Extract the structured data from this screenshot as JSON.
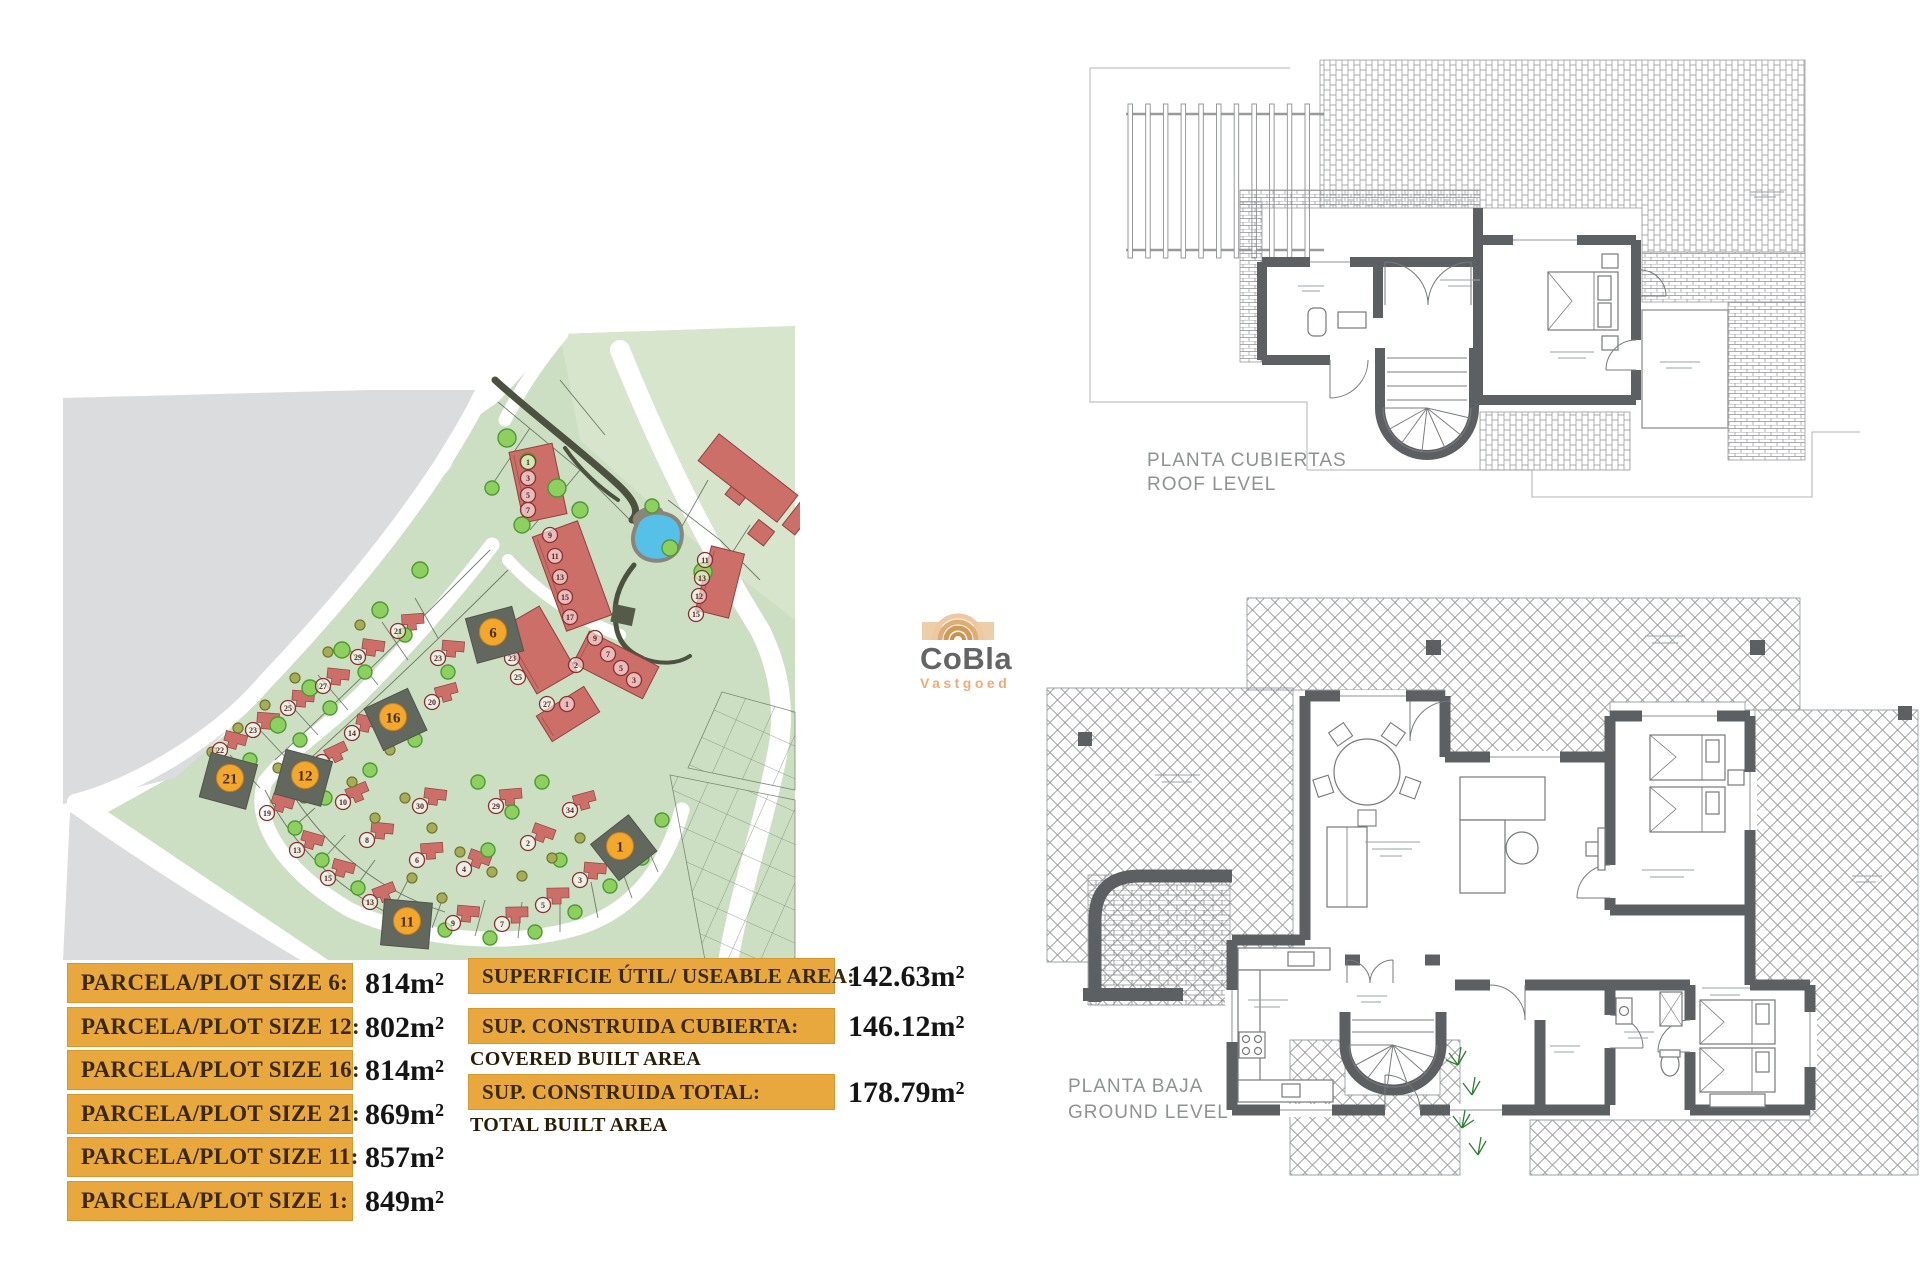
{
  "branding": {
    "logo_text": "CoBla",
    "logo_subtext": "Vastgoed"
  },
  "plot_sizes": [
    {
      "label": "PARCELA/PLOT SIZE 6:",
      "value": "814m²"
    },
    {
      "label": "PARCELA/PLOT SIZE 12:",
      "value": "802m²"
    },
    {
      "label": "PARCELA/PLOT SIZE 16:",
      "value": "814m²"
    },
    {
      "label": "PARCELA/PLOT SIZE 21:",
      "value": "869m²"
    },
    {
      "label": "PARCELA/PLOT SIZE 11:",
      "value": "857m²"
    },
    {
      "label": "PARCELA/PLOT SIZE 1:",
      "value": "849m²"
    }
  ],
  "build_areas": [
    {
      "label": "SUPERFICIE ÚTIL/ USEABLE AREA:",
      "value": "142.63m²",
      "sublabel": ""
    },
    {
      "label": "SUP. CONSTRUIDA CUBIERTA:",
      "value": "146.12m²",
      "sublabel": "COVERED BUILT AREA"
    },
    {
      "label": "SUP. CONSTRUIDA TOTAL:",
      "value": "178.79m²",
      "sublabel": "TOTAL BUILT AREA"
    }
  ],
  "floor_plans": {
    "roof": {
      "title_es": "PLANTA CUBIERTAS",
      "title_en": "ROOF LEVEL"
    },
    "ground": {
      "title_es": "PLANTA BAJA",
      "title_en": "GROUND LEVEL"
    }
  },
  "site_plan": {
    "colors": {
      "map_green": "#ccdfc2",
      "map_gray": "#dbdcdd",
      "house_red": "#cb6f68",
      "plot_dark": "#63685f",
      "highlight_orange": "#f4a72d",
      "pond_blue": "#55c1e9",
      "tree_green": "#8ed060",
      "tree_olive": "#a6ad54",
      "accent_bar": "#e9a83e"
    },
    "highlighted_plots": [
      {
        "n": "6",
        "x": 433,
        "y": 309,
        "r": -15
      },
      {
        "n": "16",
        "x": 333,
        "y": 394,
        "r": -25
      },
      {
        "n": "12",
        "x": 245,
        "y": 452,
        "r": 15
      },
      {
        "n": "21",
        "x": 170,
        "y": 455,
        "r": 15
      },
      {
        "n": "11",
        "x": 347,
        "y": 598,
        "r": 5
      },
      {
        "n": "1",
        "x": 560,
        "y": 523,
        "r": -38
      }
    ],
    "unit_markers": [
      {
        "n": "19",
        "x": 207,
        "y": 493,
        "h": 1
      },
      {
        "n": "13",
        "x": 237,
        "y": 530,
        "h": 1
      },
      {
        "n": "15",
        "x": 268,
        "y": 558,
        "h": 1
      },
      {
        "n": "13",
        "x": 310,
        "y": 582,
        "h": 1
      },
      {
        "n": "9",
        "x": 393,
        "y": 603,
        "h": 1
      },
      {
        "n": "7",
        "x": 442,
        "y": 604,
        "h": 1
      },
      {
        "n": "5",
        "x": 483,
        "y": 585,
        "h": 1
      },
      {
        "n": "3",
        "x": 520,
        "y": 560,
        "h": 1
      },
      {
        "n": "2",
        "x": 468,
        "y": 523,
        "h": 1
      },
      {
        "n": "4",
        "x": 404,
        "y": 549,
        "h": 1
      },
      {
        "n": "6",
        "x": 357,
        "y": 540,
        "h": 1
      },
      {
        "n": "8",
        "x": 307,
        "y": 520,
        "h": 1
      },
      {
        "n": "10",
        "x": 283,
        "y": 482,
        "h": 1
      },
      {
        "n": "30",
        "x": 360,
        "y": 486,
        "h": 1
      },
      {
        "n": "29",
        "x": 436,
        "y": 486,
        "h": 1
      },
      {
        "n": "34",
        "x": 510,
        "y": 490,
        "h": 1
      },
      {
        "n": "21",
        "x": 338,
        "y": 311,
        "h": 1
      },
      {
        "n": "29",
        "x": 298,
        "y": 337,
        "h": 1
      },
      {
        "n": "27",
        "x": 263,
        "y": 366,
        "h": 1
      },
      {
        "n": "25",
        "x": 228,
        "y": 388,
        "h": 1
      },
      {
        "n": "23",
        "x": 193,
        "y": 410,
        "h": 1
      },
      {
        "n": "22",
        "x": 160,
        "y": 430,
        "h": 1
      },
      {
        "n": "23",
        "x": 378,
        "y": 338,
        "h": 1
      },
      {
        "n": "20",
        "x": 372,
        "y": 382,
        "h": 1
      },
      {
        "n": "14",
        "x": 292,
        "y": 413,
        "h": 1
      },
      {
        "n": "18",
        "x": 262,
        "y": 442,
        "h": 1
      },
      {
        "n": "1",
        "x": 468,
        "y": 142,
        "h": 0
      },
      {
        "n": "3",
        "x": 468,
        "y": 158,
        "h": 0
      },
      {
        "n": "5",
        "x": 468,
        "y": 175,
        "h": 0
      },
      {
        "n": "7",
        "x": 468,
        "y": 190,
        "h": 0
      },
      {
        "n": "9",
        "x": 490,
        "y": 215,
        "h": 0
      },
      {
        "n": "11",
        "x": 495,
        "y": 236,
        "h": 0
      },
      {
        "n": "13",
        "x": 500,
        "y": 257,
        "h": 0
      },
      {
        "n": "15",
        "x": 505,
        "y": 277,
        "h": 0
      },
      {
        "n": "17",
        "x": 510,
        "y": 297,
        "h": 0
      },
      {
        "n": "19",
        "x": 440,
        "y": 298,
        "h": 0
      },
      {
        "n": "21",
        "x": 446,
        "y": 318,
        "h": 0
      },
      {
        "n": "23",
        "x": 452,
        "y": 338,
        "h": 0
      },
      {
        "n": "25",
        "x": 458,
        "y": 357,
        "h": 0
      },
      {
        "n": "27",
        "x": 487,
        "y": 384,
        "h": 0
      },
      {
        "n": "1",
        "x": 507,
        "y": 384,
        "h": 0
      },
      {
        "n": "11",
        "x": 645,
        "y": 240,
        "h": 0
      },
      {
        "n": "13",
        "x": 642,
        "y": 258,
        "h": 0
      },
      {
        "n": "12",
        "x": 639,
        "y": 276,
        "h": 0
      },
      {
        "n": "15",
        "x": 636,
        "y": 294,
        "h": 0
      },
      {
        "n": "9",
        "x": 535,
        "y": 318,
        "h": 0
      },
      {
        "n": "7",
        "x": 548,
        "y": 334,
        "h": 0
      },
      {
        "n": "5",
        "x": 561,
        "y": 348,
        "h": 0
      },
      {
        "n": "3",
        "x": 574,
        "y": 360,
        "h": 0
      },
      {
        "n": "2",
        "x": 516,
        "y": 345,
        "h": 0
      }
    ],
    "townhouse_rows": [
      {
        "x": 478,
        "y": 163,
        "w": 44,
        "h": 72,
        "r": -12
      },
      {
        "x": 512,
        "y": 256,
        "w": 48,
        "h": 100,
        "r": -20
      },
      {
        "x": 478,
        "y": 330,
        "w": 46,
        "h": 75,
        "r": -30
      },
      {
        "x": 508,
        "y": 394,
        "w": 56,
        "h": 30,
        "r": -32
      },
      {
        "x": 660,
        "y": 262,
        "w": 34,
        "h": 66,
        "r": 14
      },
      {
        "x": 556,
        "y": 345,
        "w": 78,
        "h": 36,
        "r": 27
      }
    ],
    "trees_green": [
      [
        447,
        118,
        9
      ],
      [
        468,
        141,
        8
      ],
      [
        497,
        168,
        9
      ],
      [
        520,
        190,
        8
      ],
      [
        432,
        168,
        7
      ],
      [
        462,
        205,
        8
      ],
      [
        610,
        228,
        8
      ],
      [
        643,
        252,
        9
      ],
      [
        592,
        186,
        7
      ],
      [
        360,
        250,
        8
      ],
      [
        320,
        290,
        8
      ],
      [
        282,
        330,
        8
      ],
      [
        250,
        368,
        8
      ],
      [
        218,
        405,
        8
      ],
      [
        190,
        440,
        7
      ],
      [
        240,
        420,
        7
      ],
      [
        270,
        388,
        7
      ],
      [
        305,
        352,
        7
      ],
      [
        345,
        315,
        7
      ],
      [
        388,
        352,
        7
      ],
      [
        355,
        420,
        7
      ],
      [
        310,
        450,
        7
      ],
      [
        265,
        478,
        7
      ],
      [
        235,
        508,
        7
      ],
      [
        262,
        540,
        7
      ],
      [
        298,
        568,
        7
      ],
      [
        340,
        592,
        7
      ],
      [
        385,
        610,
        7
      ],
      [
        430,
        618,
        7
      ],
      [
        475,
        612,
        7
      ],
      [
        515,
        592,
        7
      ],
      [
        550,
        566,
        7
      ],
      [
        582,
        538,
        7
      ],
      [
        602,
        500,
        7
      ],
      [
        418,
        462,
        7
      ],
      [
        452,
        492,
        7
      ],
      [
        482,
        462,
        7
      ],
      [
        428,
        530,
        7
      ],
      [
        500,
        540,
        7
      ]
    ],
    "trees_olive": [
      [
        152,
        432,
        5
      ],
      [
        178,
        408,
        5
      ],
      [
        205,
        385,
        5
      ],
      [
        235,
        358,
        5
      ],
      [
        268,
        332,
        5
      ],
      [
        300,
        305,
        5
      ],
      [
        330,
        430,
        5
      ],
      [
        292,
        462,
        5
      ],
      [
        315,
        498,
        5
      ],
      [
        345,
        478,
        5
      ],
      [
        372,
        508,
        5
      ],
      [
        400,
        532,
        5
      ],
      [
        432,
        552,
        5
      ],
      [
        462,
        556,
        5
      ],
      [
        492,
        538,
        5
      ],
      [
        520,
        518,
        5
      ],
      [
        218,
        448,
        5
      ],
      [
        244,
        478,
        5
      ],
      [
        352,
        558,
        5
      ],
      [
        382,
        578,
        5
      ]
    ]
  }
}
